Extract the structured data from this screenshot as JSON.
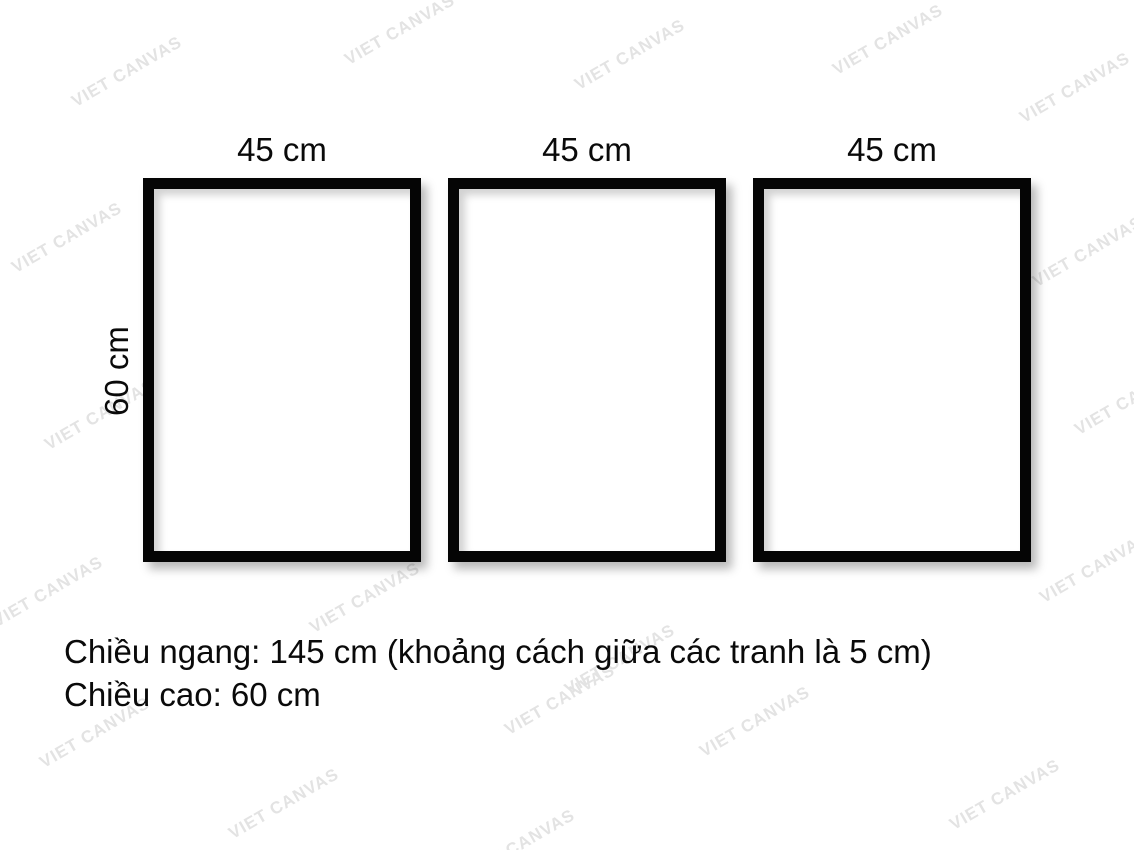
{
  "watermark": {
    "text": "VIET CANVAS",
    "color": "#e3e3e3"
  },
  "frames": [
    {
      "width_label": "45 cm"
    },
    {
      "width_label": "45 cm"
    },
    {
      "width_label": "45 cm"
    }
  ],
  "height_label": "60 cm",
  "caption": {
    "line1": "Chiều ngang: 145 cm (khoảng cách giữa các tranh là 5 cm)",
    "line2": "Chiều cao: 60 cm"
  },
  "colors": {
    "background": "#ffffff",
    "frame_border": "#050505",
    "text": "#0a0a0a",
    "watermark": "#e3e3e3"
  }
}
